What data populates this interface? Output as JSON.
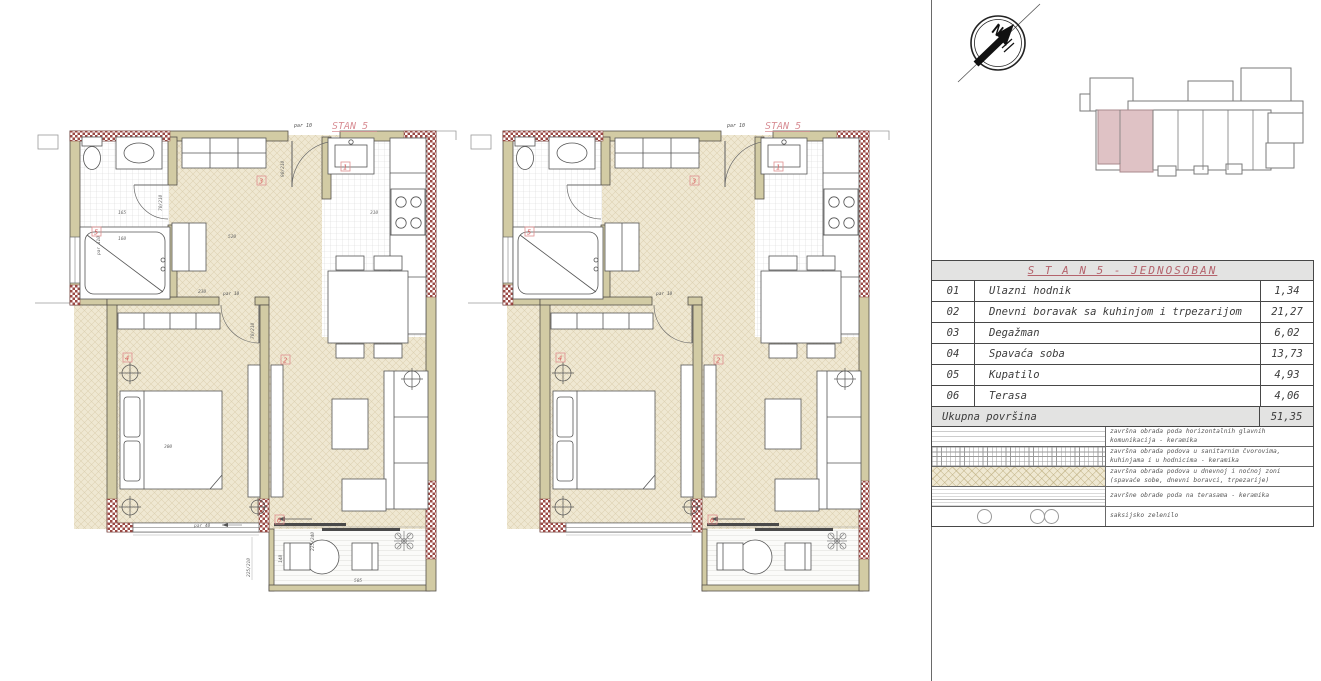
{
  "plan": {
    "stan_label": "STAN 5",
    "tags": {
      "t1": "1",
      "t2": "2",
      "t3": "3",
      "t4": "4",
      "t5": "5",
      "t6": "6"
    },
    "labels": {
      "par_top": "par 10",
      "par_mid": "par 10",
      "par_bottom": "par 40",
      "par_left": "par 110"
    },
    "dims": {
      "hall": "230",
      "corridor": "520",
      "kitchen": "310",
      "bath_a": "165",
      "bath_b": "160",
      "bed": "300",
      "chair": "148",
      "terrace": "505",
      "door_terrace": "225/240",
      "window_bed": "225/210",
      "door_entry": "90/210",
      "door_bath": "70/210",
      "door_bed": "70/210"
    }
  },
  "compass": {
    "north": "N"
  },
  "table": {
    "title": "S T A N  5 - JEDNOSOBAN",
    "rows": [
      {
        "num": "01",
        "name": "Ulazni hodnik",
        "area": "1,34"
      },
      {
        "num": "02",
        "name": "Dnevni boravak sa kuhinjom i trpezarijom",
        "area": "21,27"
      },
      {
        "num": "03",
        "name": "Degažman",
        "area": "6,02"
      },
      {
        "num": "04",
        "name": "Spavaća soba",
        "area": "13,73"
      },
      {
        "num": "05",
        "name": "Kupatilo",
        "area": "4,93"
      },
      {
        "num": "06",
        "name": "Terasa",
        "area": "4,06"
      }
    ],
    "total_label": "Ukupna površina",
    "total_area": "51,35"
  },
  "legend": {
    "items": [
      {
        "pattern": "horizontal-lines",
        "text": "završna obrada poda horizontalnih glavnih komunikacija - keramika"
      },
      {
        "pattern": "tile-grid",
        "text": "završna obrada podova u sanitarnim čvorovima, kuhinjama i u hodnicima - keramika"
      },
      {
        "pattern": "beige-hatch",
        "text": "završna obrada podova u dnevnoj i noćnoj zoni (spavaće sobe, dnevni boravci, trpezarije)"
      },
      {
        "pattern": "terrace-lines",
        "text": "završne obrade poda na terasama - keramika"
      },
      {
        "pattern": "plant-circles",
        "text": "saksijsko zelenilo"
      }
    ]
  },
  "colors": {
    "accent_red": "#b4636c",
    "label_red": "#d98f96",
    "tag_red": "#d95f5f",
    "wall_beige": "#d2cba4",
    "floor_beige": "#efe8d2",
    "insulation_red": "#9b4a45",
    "keyplan_highlight": "#dfc2c5"
  }
}
